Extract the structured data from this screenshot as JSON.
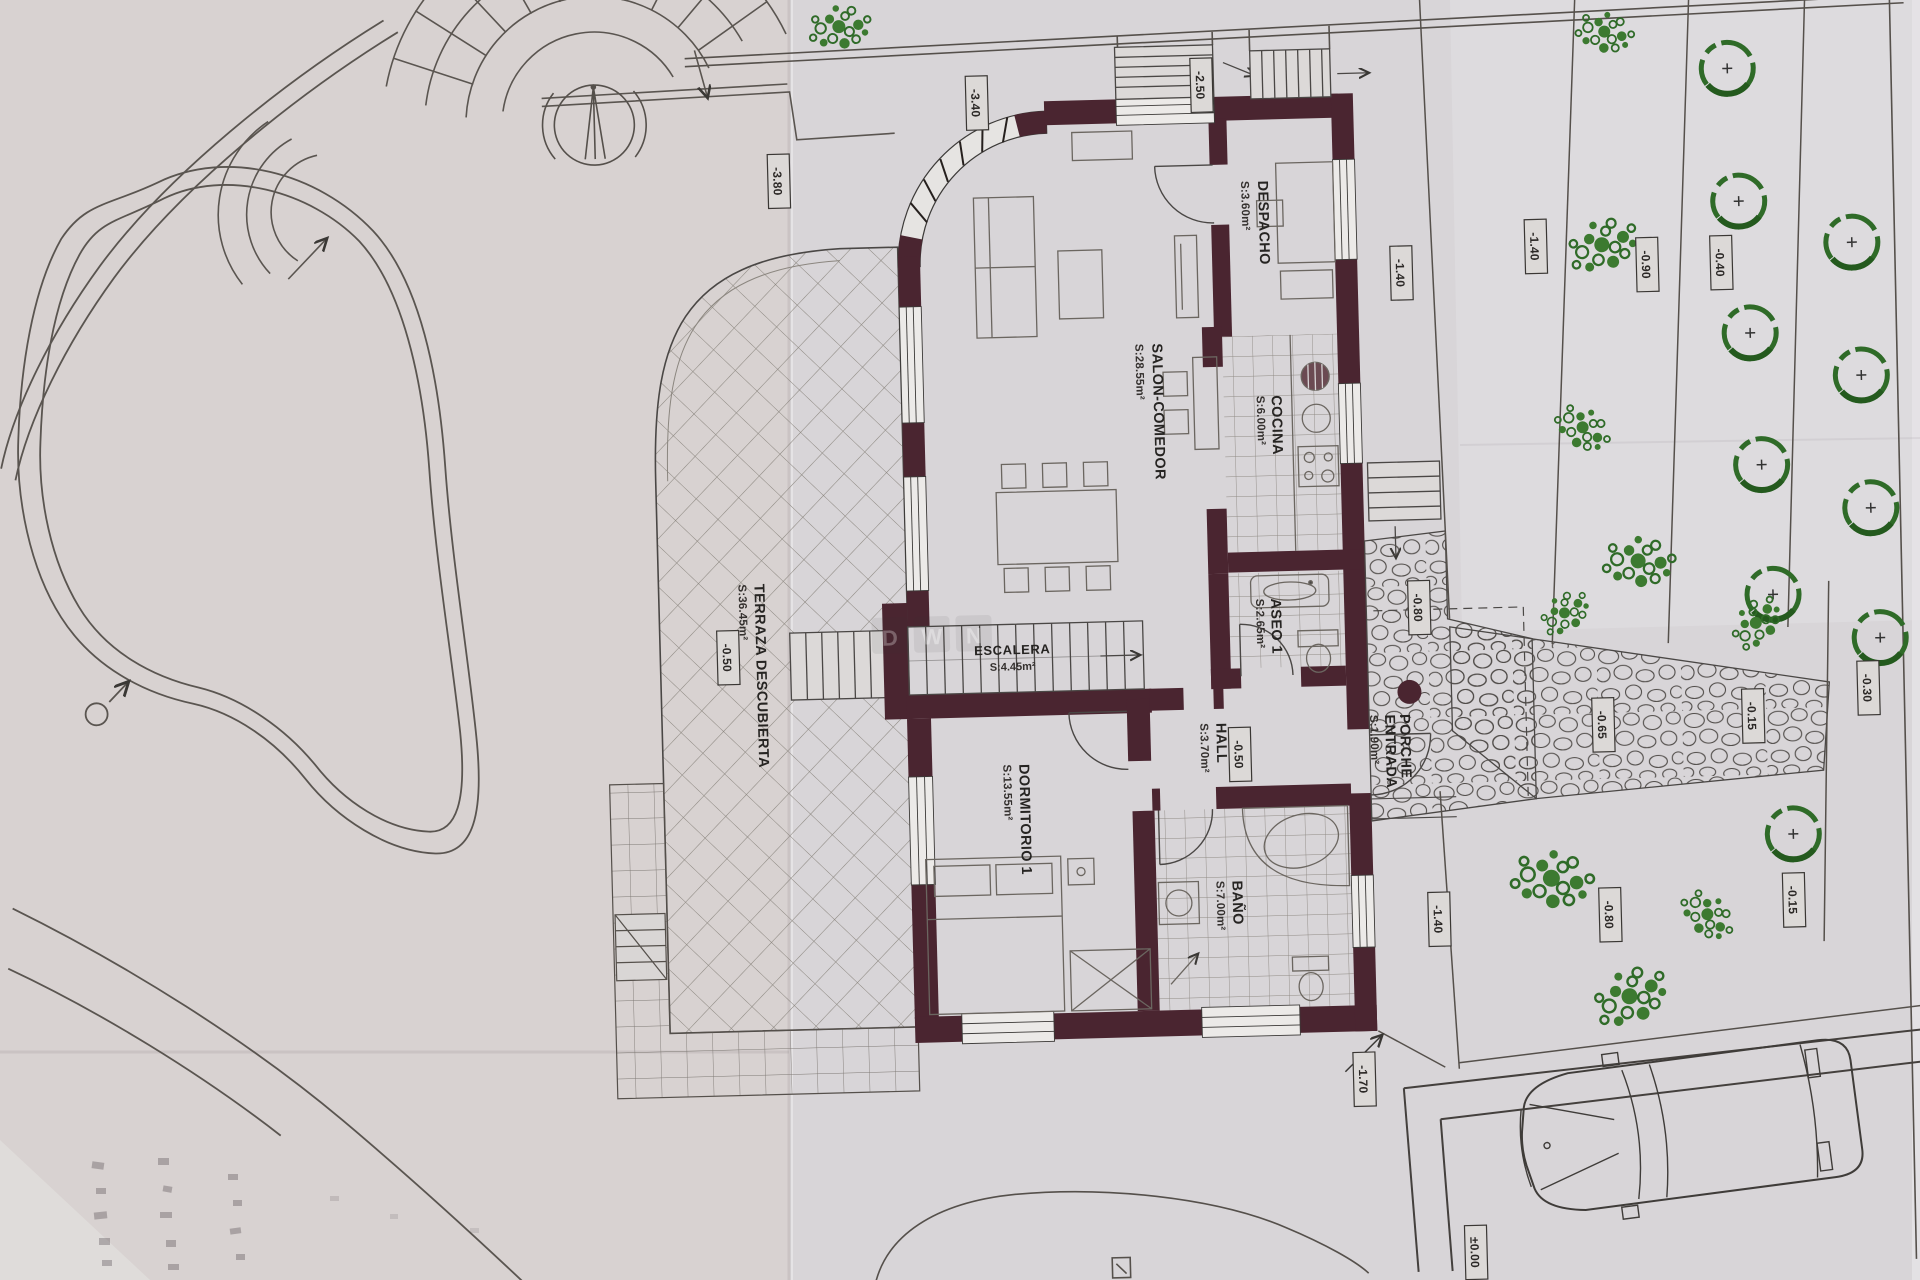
{
  "plan": {
    "rooms": [
      {
        "name": "DESPACHO",
        "area": "S:3.60m²"
      },
      {
        "name": "SALON-COMEDOR",
        "area": "S:28.55m²"
      },
      {
        "name": "COCINA",
        "area": "S:6.00m²"
      },
      {
        "name": "TERRAZA DESCUBIERTA",
        "area": "S:36.45m²"
      },
      {
        "name": "ESCALERA",
        "area": "S:4.45m²"
      },
      {
        "name": "ASEO 1",
        "area": "S:2.65m²"
      },
      {
        "name": "HALL",
        "area": "S:3.70m²"
      },
      {
        "name": "DORMITORIO 1",
        "area": "S:13.55m²"
      },
      {
        "name": "BAÑO",
        "area": "S:7.00m²"
      },
      {
        "name": "PORCHE",
        "name2": "ENTRADA",
        "area": "S:1.90m²"
      }
    ],
    "elevations": [
      {
        "value": "-3.80"
      },
      {
        "value": "-3.40"
      },
      {
        "value": "-2.50"
      },
      {
        "value": "-1.40"
      },
      {
        "value": "-1.40"
      },
      {
        "value": "-0.90"
      },
      {
        "value": "-0.40"
      },
      {
        "value": "-0.50"
      },
      {
        "value": "-0.50"
      },
      {
        "value": "-0.80"
      },
      {
        "value": "-0.30"
      },
      {
        "value": "-0.65"
      },
      {
        "value": "-0.15"
      },
      {
        "value": "-0.15"
      },
      {
        "value": "-0.80"
      },
      {
        "value": "-1.40"
      },
      {
        "value": "-1.70"
      },
      {
        "value": "±0.00"
      }
    ],
    "watermark": [
      "D",
      "W",
      "N"
    ],
    "colors": {
      "wall": "#4a2530",
      "paper": "#d7d3d4",
      "green": "#3c7a30",
      "line": "#55504b",
      "stone": "#4f4b48"
    }
  }
}
